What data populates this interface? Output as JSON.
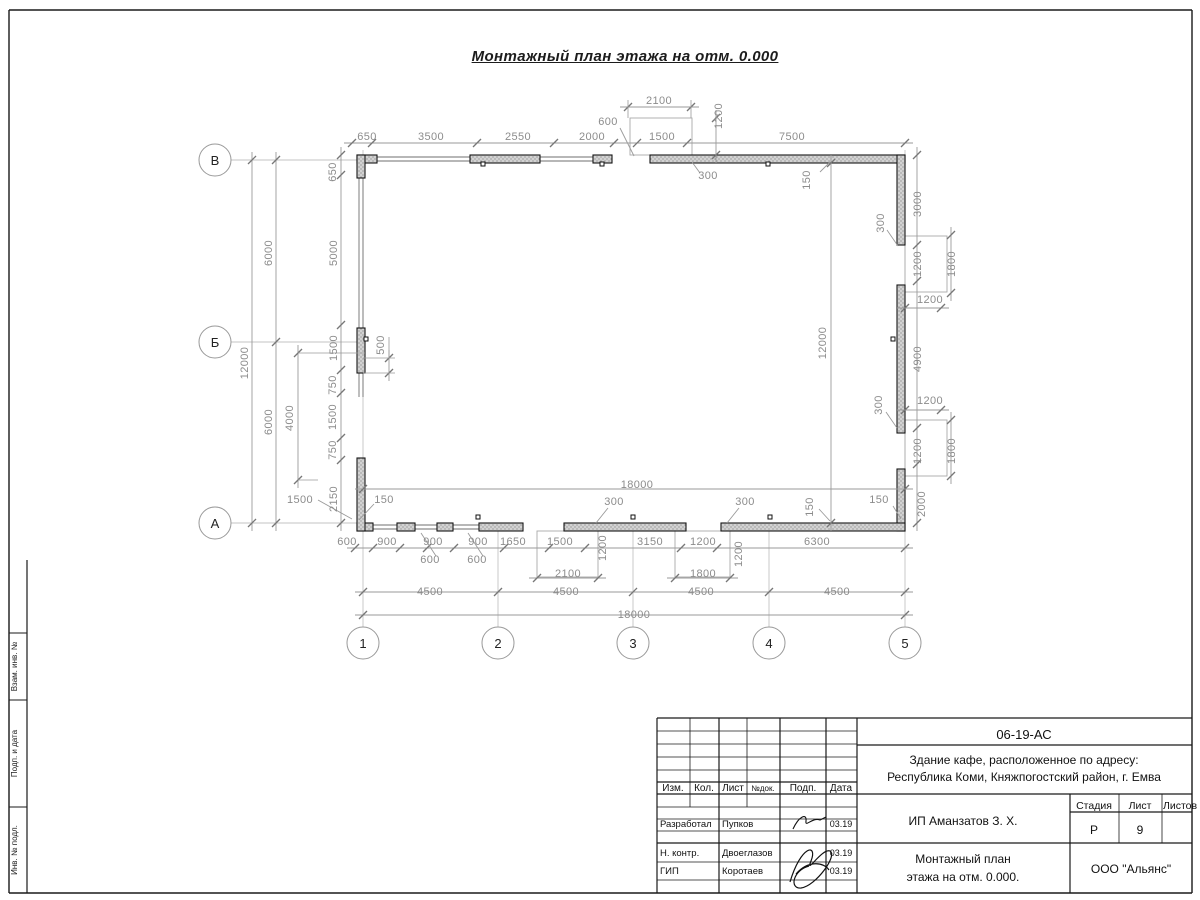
{
  "sheet": {
    "title": "Монтажный план этажа на отм. 0.000"
  },
  "colors": {
    "dim_line": "#9a9a9a",
    "dim_text": "#8c8c8c",
    "wall_stroke": "#151515",
    "wall_fill": "#cccccc",
    "axis_line": "#c3c3c3",
    "frame": "#1a1a1a"
  },
  "axes": {
    "row_circle_x": 215,
    "col_circle_y": 643,
    "rows": [
      {
        "label": "В",
        "y": 160
      },
      {
        "label": "Б",
        "y": 342
      },
      {
        "label": "А",
        "y": 523
      }
    ],
    "cols": [
      {
        "label": "1",
        "x": 363
      },
      {
        "label": "2",
        "x": 498
      },
      {
        "label": "3",
        "x": 633
      },
      {
        "label": "4",
        "x": 769
      },
      {
        "label": "5",
        "x": 905
      }
    ]
  },
  "plan": {
    "walls": [
      [
        357,
        155,
        20,
        8
      ],
      [
        357,
        155,
        8,
        23
      ],
      [
        470,
        155,
        70,
        8
      ],
      [
        593,
        155,
        19,
        8
      ],
      [
        650,
        155,
        255,
        8
      ],
      [
        897,
        155,
        8,
        90
      ],
      [
        897,
        285,
        8,
        148
      ],
      [
        897,
        469,
        8,
        62
      ],
      [
        721,
        523,
        184,
        8
      ],
      [
        564,
        523,
        122,
        8
      ],
      [
        479,
        523,
        44,
        8
      ],
      [
        437,
        523,
        16,
        8
      ],
      [
        397,
        523,
        18,
        8
      ],
      [
        357,
        523,
        16,
        8
      ],
      [
        357,
        458,
        8,
        73
      ],
      [
        357,
        328,
        8,
        45
      ]
    ],
    "windows": [
      [
        377,
        159,
        470,
        159
      ],
      [
        540,
        159,
        593,
        159
      ],
      [
        361,
        178,
        361,
        328
      ],
      [
        361,
        373,
        361,
        397
      ],
      [
        373,
        527,
        397,
        527
      ],
      [
        415,
        527,
        437,
        527
      ],
      [
        453,
        527,
        479,
        527
      ]
    ],
    "porches": [
      [
        630,
        118,
        62,
        37
      ],
      [
        905,
        236,
        42,
        56
      ],
      [
        905,
        420,
        42,
        56
      ],
      [
        537,
        531,
        61,
        46
      ],
      [
        675,
        531,
        55,
        46
      ]
    ],
    "anchor_marks": [
      [
        483,
        164
      ],
      [
        602,
        164
      ],
      [
        768,
        164
      ],
      [
        478,
        517
      ],
      [
        633,
        517
      ],
      [
        770,
        517
      ],
      [
        366,
        339
      ],
      [
        893,
        339
      ]
    ],
    "chains": [
      {
        "dir": "h",
        "y": 143,
        "ticks": [
          352,
          372,
          477,
          554,
          614,
          637,
          687,
          905
        ]
      },
      {
        "dir": "h",
        "y": 107,
        "ticks": [
          628,
          691
        ]
      },
      {
        "dir": "v",
        "x": 716,
        "ticks": [
          118,
          155
        ]
      },
      {
        "dir": "h",
        "y": 489,
        "ticks": [
          363,
          905
        ]
      },
      {
        "dir": "h",
        "y": 548,
        "ticks": [
          355,
          373,
          400,
          427,
          454,
          504,
          549,
          585,
          681,
          717,
          905
        ]
      },
      {
        "dir": "h",
        "y": 578,
        "ticks": [
          537,
          598
        ]
      },
      {
        "dir": "h",
        "y": 578,
        "ticks": [
          675,
          730
        ]
      },
      {
        "dir": "h",
        "y": 592,
        "ticks": [
          363,
          498,
          633,
          769,
          905
        ]
      },
      {
        "dir": "h",
        "y": 615,
        "ticks": [
          363,
          905
        ]
      },
      {
        "dir": "v",
        "x": 252,
        "ticks": [
          160,
          523
        ]
      },
      {
        "dir": "v",
        "x": 276,
        "ticks": [
          160,
          342,
          523
        ]
      },
      {
        "dir": "v",
        "x": 298,
        "ticks": [
          353,
          480
        ]
      },
      {
        "dir": "v",
        "x": 341,
        "ticks": [
          155,
          175,
          325,
          370,
          393,
          438,
          460,
          523
        ]
      },
      {
        "dir": "v",
        "x": 389,
        "ticks": [
          358,
          373
        ]
      },
      {
        "dir": "v",
        "x": 831,
        "ticks": [
          163,
          523
        ]
      },
      {
        "dir": "v",
        "x": 917,
        "ticks": [
          155,
          245,
          281,
          428,
          464,
          523
        ]
      },
      {
        "dir": "v",
        "x": 951,
        "ticks": [
          235,
          293
        ]
      },
      {
        "dir": "v",
        "x": 951,
        "ticks": [
          420,
          476
        ]
      },
      {
        "dir": "h",
        "y": 308,
        "ticks": [
          905,
          941
        ]
      },
      {
        "dir": "h",
        "y": 410,
        "ticks": [
          905,
          941
        ]
      }
    ],
    "ext_lines": [
      [
        298,
        353,
        365,
        353
      ],
      [
        298,
        480,
        318,
        480
      ],
      [
        363,
        358,
        395,
        358
      ],
      [
        363,
        373,
        395,
        373
      ],
      [
        389,
        337,
        389,
        358
      ],
      [
        628,
        100,
        628,
        118
      ],
      [
        691,
        100,
        691,
        118
      ]
    ],
    "leaders": [
      [
        620,
        128,
        634,
        156
      ],
      [
        700,
        173,
        692,
        162
      ],
      [
        820,
        172,
        830,
        162
      ],
      [
        421,
        533,
        436,
        556
      ],
      [
        468,
        533,
        483,
        556
      ],
      [
        318,
        500,
        352,
        519
      ],
      [
        374,
        504,
        359,
        520
      ],
      [
        608,
        508,
        596,
        523
      ],
      [
        739,
        508,
        727,
        523
      ],
      [
        893,
        506,
        901,
        519
      ],
      [
        819,
        509,
        830,
        521
      ],
      [
        887,
        230,
        898,
        246
      ],
      [
        886,
        412,
        897,
        428
      ]
    ],
    "dim_labels": [
      {
        "t": "650",
        "x": 367,
        "y": 140
      },
      {
        "t": "3500",
        "x": 431,
        "y": 140
      },
      {
        "t": "2550",
        "x": 518,
        "y": 140
      },
      {
        "t": "2000",
        "x": 592,
        "y": 140
      },
      {
        "t": "1500",
        "x": 662,
        "y": 140
      },
      {
        "t": "600",
        "x": 608,
        "y": 125
      },
      {
        "t": "2100",
        "x": 659,
        "y": 104
      },
      {
        "t": "1200",
        "x": 722,
        "y": 116,
        "r": 1
      },
      {
        "t": "7500",
        "x": 792,
        "y": 140
      },
      {
        "t": "650",
        "x": 336,
        "y": 172,
        "r": 1
      },
      {
        "t": "300",
        "x": 708,
        "y": 179
      },
      {
        "t": "150",
        "x": 810,
        "y": 180,
        "r": 1
      },
      {
        "t": "12000",
        "x": 248,
        "y": 363,
        "r": 1
      },
      {
        "t": "6000",
        "x": 272,
        "y": 253,
        "r": 1
      },
      {
        "t": "6000",
        "x": 272,
        "y": 422,
        "r": 1
      },
      {
        "t": "4000",
        "x": 293,
        "y": 418,
        "r": 1
      },
      {
        "t": "5000",
        "x": 337,
        "y": 253,
        "r": 1
      },
      {
        "t": "1500",
        "x": 337,
        "y": 348,
        "r": 1
      },
      {
        "t": "750",
        "x": 336,
        "y": 385,
        "r": 1
      },
      {
        "t": "1500",
        "x": 336,
        "y": 417,
        "r": 1
      },
      {
        "t": "750",
        "x": 336,
        "y": 450,
        "r": 1
      },
      {
        "t": "2150",
        "x": 337,
        "y": 499,
        "r": 1
      },
      {
        "t": "500",
        "x": 384,
        "y": 345,
        "r": 1
      },
      {
        "t": "1500",
        "x": 300,
        "y": 503
      },
      {
        "t": "150",
        "x": 384,
        "y": 503
      },
      {
        "t": "600",
        "x": 347,
        "y": 545
      },
      {
        "t": "900",
        "x": 387,
        "y": 545
      },
      {
        "t": "900",
        "x": 433,
        "y": 545
      },
      {
        "t": "900",
        "x": 478,
        "y": 545
      },
      {
        "t": "1650",
        "x": 513,
        "y": 545
      },
      {
        "t": "1500",
        "x": 560,
        "y": 545
      },
      {
        "t": "1200",
        "x": 606,
        "y": 548,
        "r": 1
      },
      {
        "t": "3150",
        "x": 650,
        "y": 545
      },
      {
        "t": "1200",
        "x": 703,
        "y": 545
      },
      {
        "t": "1200",
        "x": 742,
        "y": 554,
        "r": 1
      },
      {
        "t": "6300",
        "x": 817,
        "y": 545
      },
      {
        "t": "600",
        "x": 430,
        "y": 563
      },
      {
        "t": "600",
        "x": 477,
        "y": 563
      },
      {
        "t": "2100",
        "x": 568,
        "y": 577
      },
      {
        "t": "1800",
        "x": 703,
        "y": 577
      },
      {
        "t": "300",
        "x": 614,
        "y": 505
      },
      {
        "t": "300",
        "x": 745,
        "y": 505
      },
      {
        "t": "150",
        "x": 813,
        "y": 507,
        "r": 1
      },
      {
        "t": "150",
        "x": 879,
        "y": 503
      },
      {
        "t": "18000",
        "x": 637,
        "y": 488
      },
      {
        "t": "4500",
        "x": 430,
        "y": 595
      },
      {
        "t": "4500",
        "x": 566,
        "y": 595
      },
      {
        "t": "4500",
        "x": 701,
        "y": 595
      },
      {
        "t": "4500",
        "x": 837,
        "y": 595
      },
      {
        "t": "18000",
        "x": 634,
        "y": 618
      },
      {
        "t": "3000",
        "x": 921,
        "y": 204,
        "r": 1
      },
      {
        "t": "300",
        "x": 884,
        "y": 223,
        "r": 1
      },
      {
        "t": "1200",
        "x": 921,
        "y": 264,
        "r": 1
      },
      {
        "t": "1800",
        "x": 955,
        "y": 264,
        "r": 1
      },
      {
        "t": "1200",
        "x": 930,
        "y": 303
      },
      {
        "t": "4900",
        "x": 921,
        "y": 359,
        "r": 1
      },
      {
        "t": "1200",
        "x": 930,
        "y": 404
      },
      {
        "t": "300",
        "x": 882,
        "y": 405,
        "r": 1
      },
      {
        "t": "1200",
        "x": 921,
        "y": 451,
        "r": 1
      },
      {
        "t": "1800",
        "x": 955,
        "y": 451,
        "r": 1
      },
      {
        "t": "2000",
        "x": 925,
        "y": 504,
        "r": 1
      },
      {
        "t": "12000",
        "x": 826,
        "y": 343,
        "r": 1
      }
    ]
  },
  "left_strip": {
    "cells": [
      {
        "label": "Взам. инв. №"
      },
      {
        "label": "Подп. и дата"
      },
      {
        "label": "Инв. № подл."
      }
    ]
  },
  "titleblock": {
    "doc_number": "06-19-АС",
    "project_line1": "Здание кафе, расположенное по адресу:",
    "project_line2": "Республика Коми, Княжпогостский район, г. Емва",
    "header": {
      "izm": "Изм.",
      "kol": "Кол.",
      "list": "Лист",
      "ndok": "№док.",
      "podp": "Подп.",
      "data": "Дата"
    },
    "rows": [
      {
        "role": "Разработал",
        "name": "Пупков",
        "date": "03.19"
      },
      {
        "role": "Н. контр.",
        "name": "Двоеглазов",
        "date": "03.19"
      },
      {
        "role": "ГИП",
        "name": "Коротаев",
        "date": "03.19"
      }
    ],
    "client": "ИП Аманзатов З. Х.",
    "stage_label": "Стадия",
    "sheet_label": "Лист",
    "sheets_label": "Листов",
    "stage": "Р",
    "sheet": "9",
    "sheets": "",
    "plan_title_line1": "Монтажный план",
    "plan_title_line2": "этажа на отм. 0.000.",
    "company": "ООО \"Альянс\""
  }
}
